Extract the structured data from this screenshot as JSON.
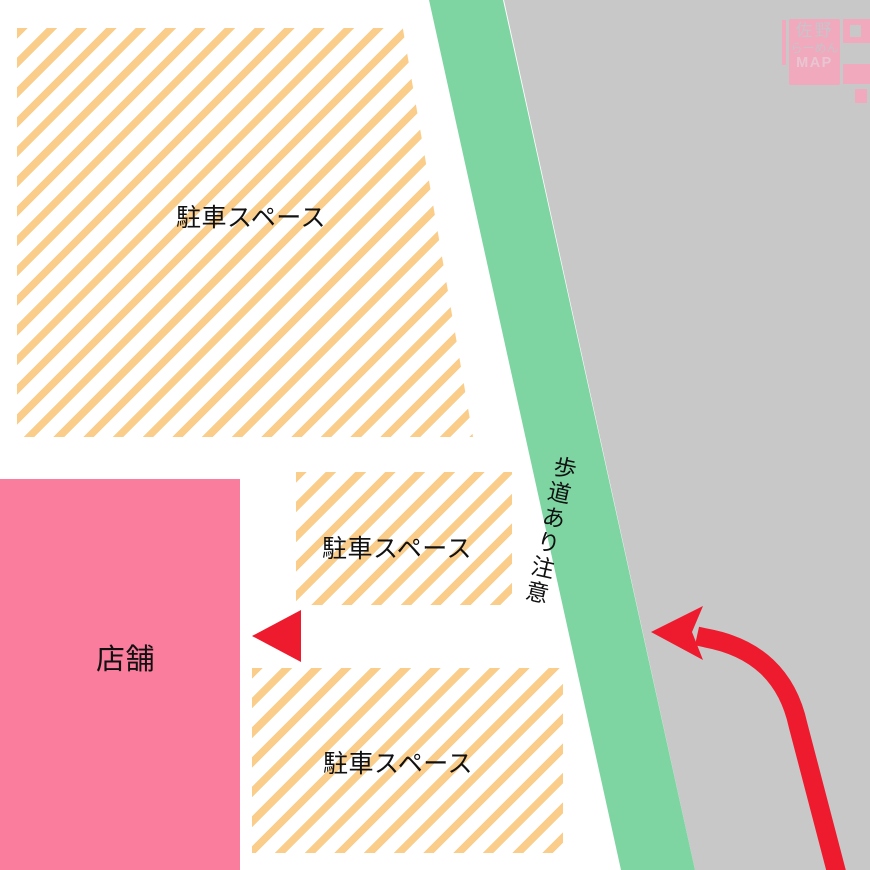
{
  "map": {
    "areas": {
      "parking_main": {
        "label": "駐車スペース"
      },
      "parking_middle": {
        "label": "駐車スペース"
      },
      "parking_lower": {
        "label": "駐車スペース"
      },
      "store": {
        "label": "店舗"
      },
      "sidewalk": {
        "label": "歩道あり注意"
      }
    }
  },
  "logo": {
    "line1": "佐野",
    "line2": "らーめん",
    "line3": "MAP"
  },
  "colors": {
    "stripe_orange": "#FBCD8A",
    "panel_white": "#FFFFFF",
    "store_pink": "#FB7D9D",
    "road_green": "#7ED5A2",
    "area_gray": "#C8C8C8",
    "arrow_red": "#ED1B2D",
    "ink": "#111111",
    "logo_pink": "#F0A9BD",
    "logo_text_gray": "#C7C4CA",
    "logo_map_pink": "#E9C5D2"
  }
}
